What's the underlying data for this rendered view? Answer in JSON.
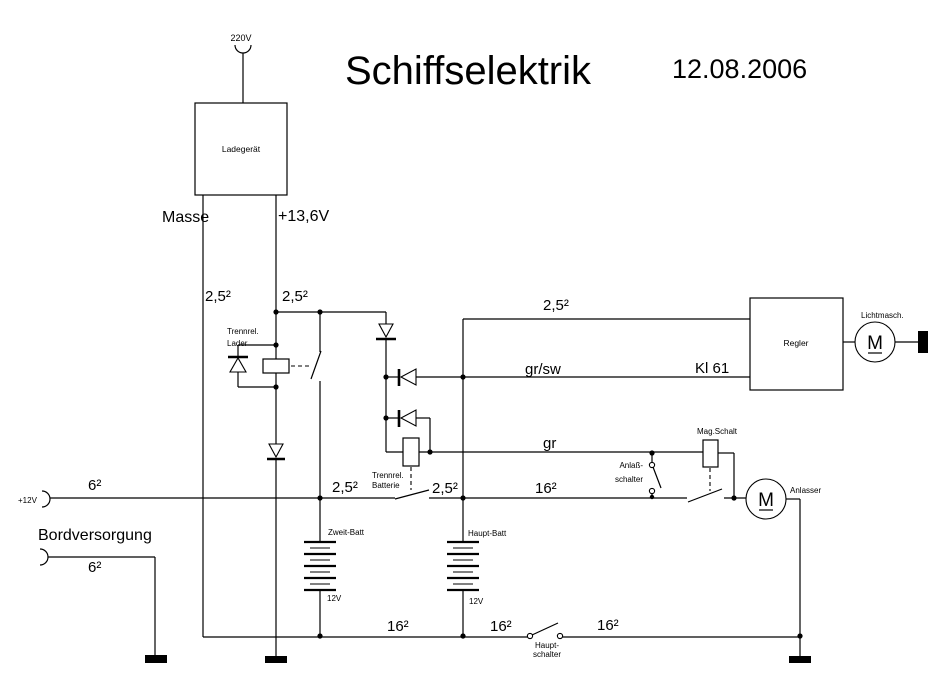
{
  "title": "Schiffselektrik",
  "date": "12.08.2006",
  "colors": {
    "line": "#000000",
    "background": "#ffffff"
  },
  "charger": {
    "label": "Ladegerät",
    "ac_input": "220V",
    "neg_terminal": "Masse",
    "pos_terminal": "+13,6V"
  },
  "relay_lader": {
    "name1": "Trennrel.",
    "name2": "Lader"
  },
  "relay_batterie": {
    "name1": "Trennrel.",
    "name2": "Batterie"
  },
  "regulator": {
    "label": "Regler",
    "terminal": "Kl 61"
  },
  "alternator": {
    "label": "Lichtmasch.",
    "letter": "M"
  },
  "starter": {
    "label": "Anlasser",
    "letter": "M"
  },
  "solenoid": {
    "label": "Mag.Schalt"
  },
  "starter_switch": {
    "name1": "Anlaß-",
    "name2": "schalter"
  },
  "main_switch": {
    "name1": "Haupt-",
    "name2": "schalter"
  },
  "battery_second": {
    "label": "Zweit-Batt",
    "voltage": "12V"
  },
  "battery_main": {
    "label": "Haupt-Batt",
    "voltage": "12V"
  },
  "supply": {
    "plus": "+12V",
    "label": "Bordversorgung"
  },
  "wire": {
    "s25": "2,5²",
    "s6": "6²",
    "s16": "16²",
    "gr": "gr",
    "grsw": "gr/sw"
  }
}
